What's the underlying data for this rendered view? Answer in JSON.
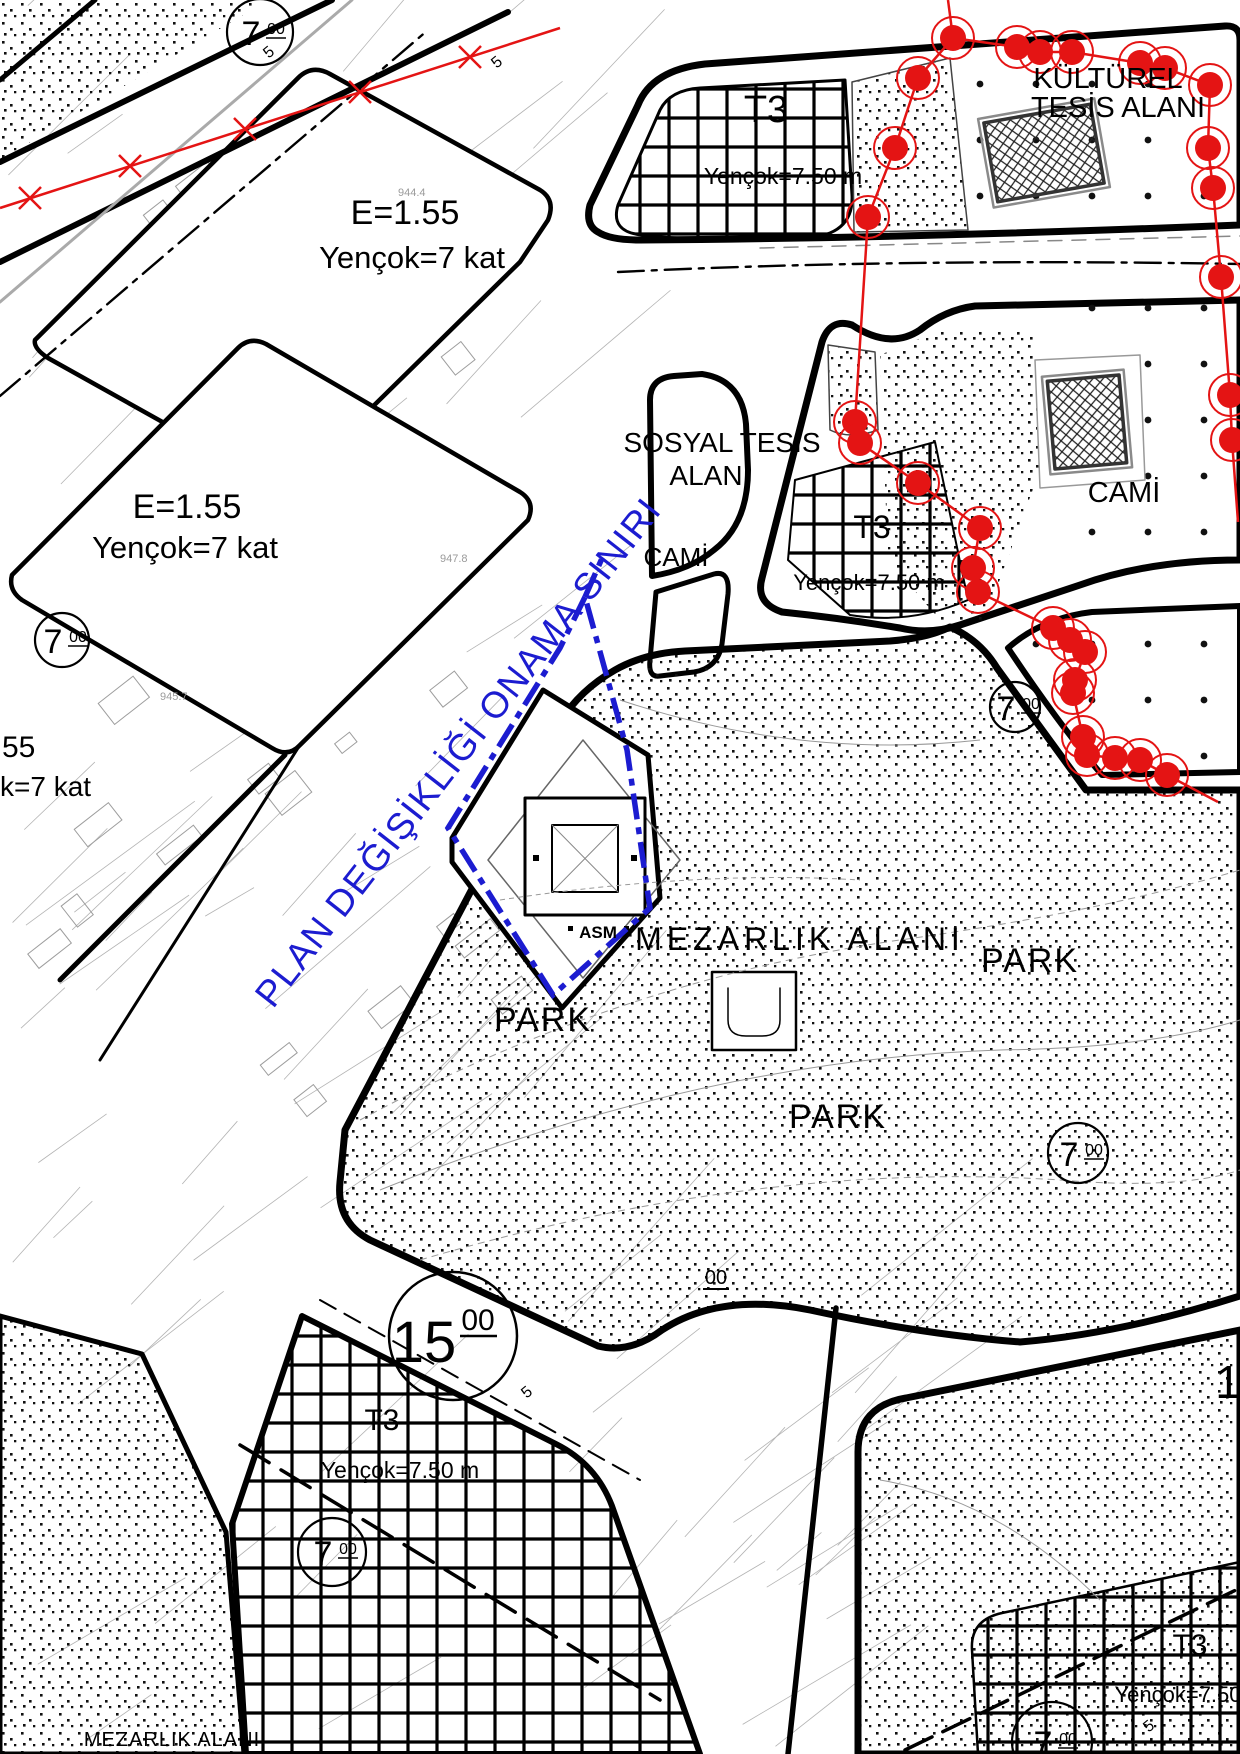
{
  "map": {
    "plan_boundary_label": "PLAN DEĞİŞİKLİĞİ ONAMA SINIRI",
    "zones": {
      "residential_1": {
        "line1": "E=1.55",
        "line2": "Yençok=7 kat"
      },
      "residential_2": {
        "line1": "E=1.55",
        "line2": "Yençok=7 kat"
      },
      "residential_cut": {
        "line1": "55",
        "line2": "k=7 kat"
      },
      "t3_top": {
        "name": "T3",
        "height": "Yençok=7.50 m"
      },
      "t3_mid": {
        "name": "T3",
        "height": "Yençok=7.50 m"
      },
      "t3_bottom_left": {
        "name": "T3",
        "height": "Yençok=7.50 m"
      },
      "t3_bottom_right": {
        "name": "T3",
        "height": "Yençok=7.50"
      },
      "cultural": {
        "line1": "KÜLTÜREL",
        "line2": "TESİS ALANI"
      },
      "social": {
        "line1": "SOSYAL TESİS",
        "line2": "ALAN"
      },
      "mosque_small": "CAMİ",
      "mosque_right": "CAMİ",
      "cemetery": "MEZARLIK ALANI",
      "cemetery_bottom": "MEZARLIK ALANI",
      "park_1": "PARK",
      "park_2": "PARK",
      "park_3": "PARK",
      "asm": "ASM"
    },
    "road_markers": {
      "w15": {
        "main": "15",
        "sup": "00"
      },
      "w7": {
        "main": "7",
        "sup": "00"
      },
      "w00": "00",
      "right_edge_number": "1",
      "width5": "5"
    },
    "survey_labels": {
      "s1": "944.4",
      "s2": "945.7",
      "s3": "947.8"
    },
    "colors": {
      "boundary_red": "#e41414",
      "plan_blue": "#1c1cd0",
      "linework_black": "#000000",
      "cadastral_gray": "#a8a8a8"
    }
  }
}
